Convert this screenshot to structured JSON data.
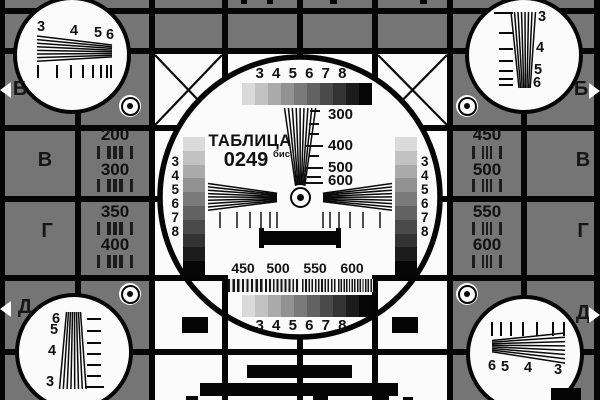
{
  "colors": {
    "background": "#757575",
    "grid_line": "#050505",
    "panel_white": "#fbfbfb",
    "ink": "#111111"
  },
  "center": {
    "title": "ТАБЛИЦА",
    "code": "0249",
    "code_suffix": "бис",
    "grayscale_labels_top": "3 4 5 6 7 8",
    "grayscale_labels_bottom": "3 4 5 6 7 8",
    "grayscale_labels_left": [
      "3",
      "4",
      "5",
      "6",
      "7",
      "8"
    ],
    "grayscale_labels_right": [
      "3",
      "4",
      "5",
      "6",
      "7",
      "8"
    ],
    "resolution_scale": [
      "300",
      "400",
      "500",
      "600"
    ],
    "burst_labels": [
      "450",
      "500",
      "550",
      "600"
    ],
    "grayscale_steps": [
      "#dadada",
      "#c2c2c2",
      "#aaaaaa",
      "#929292",
      "#7a7a7a",
      "#626262",
      "#4a4a4a",
      "#333333",
      "#1c1c1c",
      "#060606"
    ]
  },
  "left_column": {
    "cell_top": [
      "200",
      "300"
    ],
    "cell_bottom": [
      "350",
      "400"
    ]
  },
  "right_column": {
    "cell_top": [
      "450",
      "500"
    ],
    "cell_bottom": [
      "550",
      "600"
    ]
  },
  "edge_rows": {
    "left": [
      "Б",
      "В",
      "Г",
      "Д"
    ],
    "right": [
      "Б",
      "В",
      "Г",
      "Д"
    ]
  },
  "corners": {
    "top_left": [
      "3",
      "4",
      "5",
      "6"
    ],
    "top_right": [
      "3",
      "4",
      "5",
      "6"
    ],
    "bottom_left": [
      "6",
      "5",
      "4",
      "3"
    ],
    "bottom_right": [
      "6",
      "5",
      "4",
      "3"
    ]
  }
}
